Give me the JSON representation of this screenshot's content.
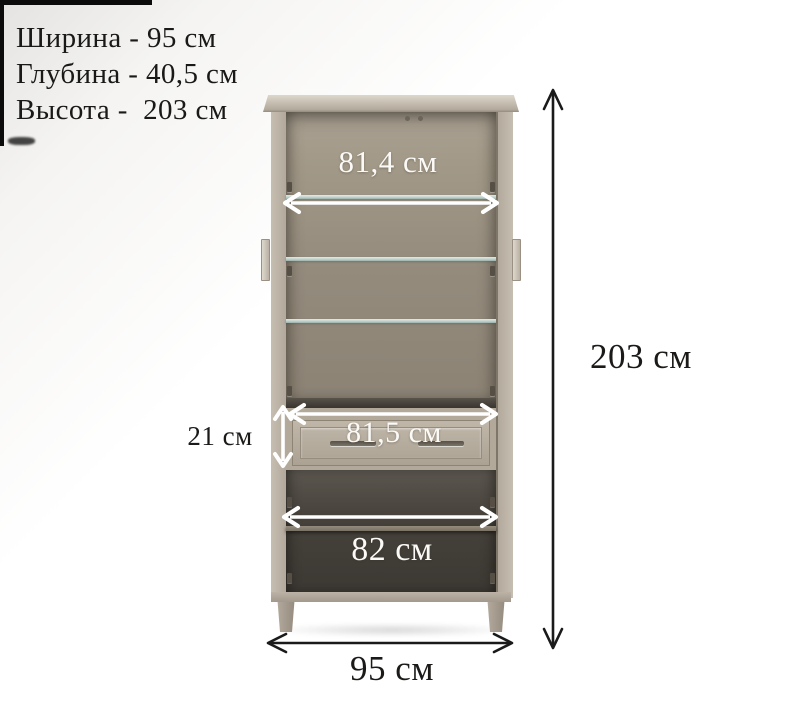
{
  "specs": {
    "lines": [
      {
        "name": "width",
        "text": "Ширина - 95 см"
      },
      {
        "name": "depth",
        "text": "Глубина - 40,5 см"
      },
      {
        "name": "height",
        "text": "Высота -  203 см"
      }
    ]
  },
  "dimensions": {
    "upper_inner_width": {
      "label": "81,4 см"
    },
    "drawer_width": {
      "label": "81,5 см"
    },
    "drawer_height": {
      "label": "21 см"
    },
    "lower_inner_width": {
      "label": "82 см"
    },
    "overall_width": {
      "label": "95 см"
    },
    "overall_height": {
      "label": "203 см"
    }
  },
  "cabinet": {
    "description": "display cabinet with open glass doors, three glass shelves, one drawer and lower two-door cupboard",
    "colors": {
      "frame": "#bcb3a6",
      "crown_highlight": "#ddd7cc",
      "interior_upper": "#948b7d",
      "interior_lower": "#46423b",
      "glass_shelf": "#c3d6d1",
      "drawer_face": "#b8afa1",
      "arrow_white": "#ffffff",
      "arrow_dark": "#1a1a1a"
    }
  }
}
